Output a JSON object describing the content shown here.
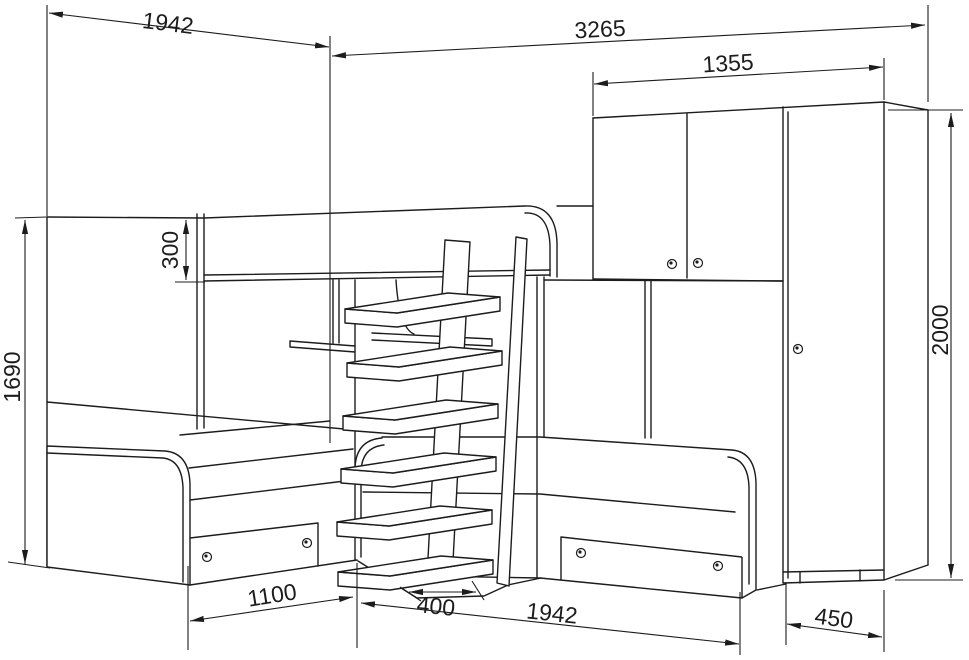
{
  "drawing": {
    "kind": "furniture dimensional line drawing",
    "subject": "corner bunk-bed set: top bunk with ladder, two lower beds with drawers, overhead cabinet and wardrobe"
  },
  "dimensions": {
    "left_section_width": "1942",
    "overall_width": "3265",
    "cabinet_width": "1355",
    "guard_rail_height": "300",
    "left_panel_height": "1690",
    "wardrobe_height": "2000",
    "left_bed_front": "1100",
    "ladder_depth": "400",
    "right_bed_length": "1942",
    "wardrobe_depth": "450"
  },
  "style": {
    "line_color": "#1c1c1c",
    "background": "#ffffff"
  }
}
